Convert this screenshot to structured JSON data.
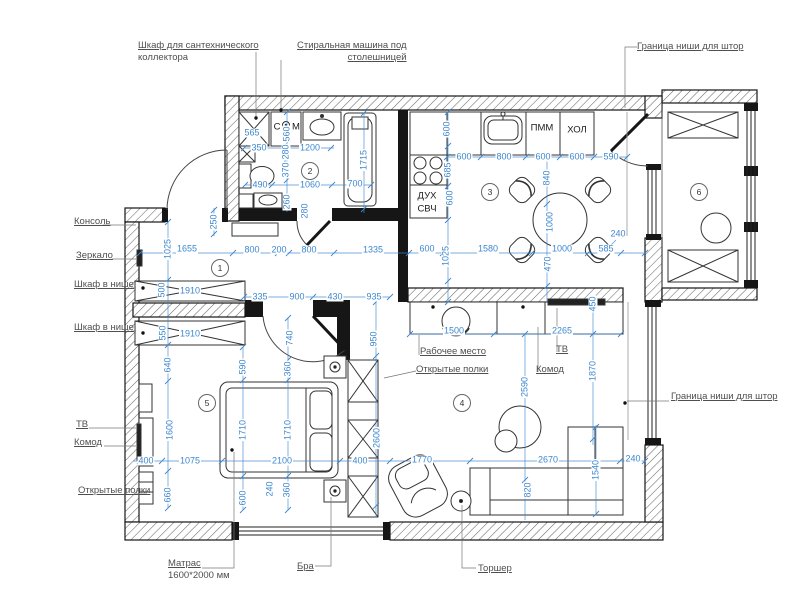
{
  "title": "Apartment furniture floor plan",
  "colors": {
    "dimension": "#3d87cf",
    "callout": "#4f4f4f",
    "wall": "#1c1c1c"
  },
  "rooms": [
    {
      "n": "1",
      "x": 220,
      "y": 268
    },
    {
      "n": "2",
      "x": 310,
      "y": 171
    },
    {
      "n": "3",
      "x": 490,
      "y": 192
    },
    {
      "n": "4",
      "x": 462,
      "y": 403
    },
    {
      "n": "5",
      "x": 207,
      "y": 403
    },
    {
      "n": "6",
      "x": 699,
      "y": 192
    }
  ],
  "plan_labels": [
    {
      "t": "С",
      "x": 277,
      "y": 127
    },
    {
      "t": "М",
      "x": 296,
      "y": 127
    },
    {
      "t": "ДУХ",
      "x": 427,
      "y": 196
    },
    {
      "t": "СВЧ",
      "x": 427,
      "y": 209
    },
    {
      "t": "ПММ",
      "x": 542,
      "y": 128
    },
    {
      "t": "ХОЛ",
      "x": 577,
      "y": 130
    },
    {
      "t": "ТВ",
      "x": 0,
      "y": 0,
      "hidden": true
    }
  ],
  "callouts": [
    {
      "name": "plumbing-cabinet-label",
      "x": 138,
      "y": 40,
      "lines": [
        {
          "t": "Шкаф для сантехнического",
          "u": true
        },
        {
          "t": "коллектора",
          "u": false
        }
      ]
    },
    {
      "name": "washer-label",
      "x": 297,
      "y": 40,
      "align": "right",
      "lines": [
        {
          "t": "Стиральная машина под",
          "u": true
        },
        {
          "t": "столешницей",
          "u": true
        }
      ]
    },
    {
      "name": "curtain-niche-top-label",
      "x": 637,
      "y": 41,
      "lines": [
        {
          "t": "Граница ниши для штор",
          "u": true
        }
      ]
    },
    {
      "name": "curtain-niche-right-label",
      "x": 671,
      "y": 391,
      "lines": [
        {
          "t": "Граница ниши для штор",
          "u": true
        }
      ]
    },
    {
      "name": "console-label",
      "x": 74,
      "y": 216,
      "lines": [
        {
          "t": "Консоль",
          "u": true
        }
      ]
    },
    {
      "name": "mirror-label",
      "x": 76,
      "y": 250,
      "lines": [
        {
          "t": "Зеркало",
          "u": true
        }
      ]
    },
    {
      "name": "niche-wardrobe-label-1",
      "x": 74,
      "y": 279,
      "lines": [
        {
          "t": "Шкаф в нише",
          "u": true
        }
      ]
    },
    {
      "name": "niche-wardrobe-label-2",
      "x": 74,
      "y": 322,
      "lines": [
        {
          "t": "Шкаф в нише",
          "u": true
        }
      ]
    },
    {
      "name": "tv-left-label",
      "x": 76,
      "y": 419,
      "lines": [
        {
          "t": "ТВ",
          "u": true
        }
      ]
    },
    {
      "name": "dresser-left-label",
      "x": 74,
      "y": 437,
      "lines": [
        {
          "t": "Комод",
          "u": true
        }
      ]
    },
    {
      "name": "shelves-left-label",
      "x": 78,
      "y": 485,
      "lines": [
        {
          "t": "Открытые полки",
          "u": true
        }
      ]
    },
    {
      "name": "mattress-label",
      "x": 168,
      "y": 558,
      "lines": [
        {
          "t": "Матрас",
          "u": true
        },
        {
          "t": "1600*2000 мм",
          "u": false
        }
      ]
    },
    {
      "name": "sconce-label",
      "x": 297,
      "y": 561,
      "lines": [
        {
          "t": "Бра",
          "u": true
        }
      ]
    },
    {
      "name": "floorlamp-label",
      "x": 478,
      "y": 563,
      "lines": [
        {
          "t": "Торшер",
          "u": true
        }
      ]
    },
    {
      "name": "workplace-label",
      "x": 420,
      "y": 346,
      "lines": [
        {
          "t": "Рабочее место",
          "u": true
        }
      ]
    },
    {
      "name": "tv-living-label",
      "x": 556,
      "y": 344,
      "lines": [
        {
          "t": "ТВ",
          "u": true
        }
      ]
    },
    {
      "name": "dresser-living-label",
      "x": 536,
      "y": 364,
      "lines": [
        {
          "t": "Комод",
          "u": true
        }
      ]
    },
    {
      "name": "shelves-living-label",
      "x": 416,
      "y": 364,
      "lines": [
        {
          "t": "Открытые полки",
          "u": true
        }
      ]
    }
  ],
  "dimensions": [
    {
      "t": "565",
      "x": 252,
      "y": 133
    },
    {
      "t": "350",
      "x": 259,
      "y": 148
    },
    {
      "t": "560",
      "x": 287,
      "y": 134,
      "v": true
    },
    {
      "t": "280",
      "x": 286,
      "y": 152,
      "v": true
    },
    {
      "t": "1200",
      "x": 310,
      "y": 148
    },
    {
      "t": "370",
      "x": 286,
      "y": 170,
      "v": true
    },
    {
      "t": "490",
      "x": 260,
      "y": 185
    },
    {
      "t": "1060",
      "x": 310,
      "y": 185
    },
    {
      "t": "700",
      "x": 355,
      "y": 184
    },
    {
      "t": "1715",
      "x": 364,
      "y": 160,
      "v": true
    },
    {
      "t": "260",
      "x": 287,
      "y": 202,
      "v": true
    },
    {
      "t": "280",
      "x": 305,
      "y": 211,
      "v": true
    },
    {
      "t": "250",
      "x": 214,
      "y": 222,
      "v": true
    },
    {
      "t": "600",
      "x": 447,
      "y": 129,
      "v": true
    },
    {
      "t": "600",
      "x": 464,
      "y": 157
    },
    {
      "t": "800",
      "x": 504,
      "y": 157
    },
    {
      "t": "600",
      "x": 543,
      "y": 157
    },
    {
      "t": "600",
      "x": 577,
      "y": 157
    },
    {
      "t": "590",
      "x": 611,
      "y": 157
    },
    {
      "t": "685",
      "x": 448,
      "y": 170,
      "v": true
    },
    {
      "t": "840",
      "x": 547,
      "y": 178,
      "v": true
    },
    {
      "t": "600",
      "x": 450,
      "y": 198,
      "v": true
    },
    {
      "t": "1000",
      "x": 550,
      "y": 222,
      "v": true
    },
    {
      "t": "240",
      "x": 618,
      "y": 234
    },
    {
      "t": "585",
      "x": 606,
      "y": 249
    },
    {
      "t": "1000",
      "x": 562,
      "y": 249
    },
    {
      "t": "1580",
      "x": 488,
      "y": 249
    },
    {
      "t": "600",
      "x": 427,
      "y": 249
    },
    {
      "t": "1025",
      "x": 446,
      "y": 256,
      "v": true
    },
    {
      "t": "470",
      "x": 548,
      "y": 264,
      "v": true
    },
    {
      "t": "1025",
      "x": 168,
      "y": 249,
      "v": true
    },
    {
      "t": "1655",
      "x": 187,
      "y": 249
    },
    {
      "t": "800",
      "x": 252,
      "y": 250
    },
    {
      "t": "200",
      "x": 279,
      "y": 250
    },
    {
      "t": "800",
      "x": 309,
      "y": 250
    },
    {
      "t": "1335",
      "x": 373,
      "y": 250
    },
    {
      "t": "500",
      "x": 162,
      "y": 290,
      "v": true
    },
    {
      "t": "1910",
      "x": 190,
      "y": 291
    },
    {
      "t": "335",
      "x": 260,
      "y": 297
    },
    {
      "t": "900",
      "x": 297,
      "y": 297
    },
    {
      "t": "430",
      "x": 335,
      "y": 297
    },
    {
      "t": "935",
      "x": 374,
      "y": 297
    },
    {
      "t": "550",
      "x": 163,
      "y": 333,
      "v": true
    },
    {
      "t": "1910",
      "x": 190,
      "y": 334
    },
    {
      "t": "740",
      "x": 290,
      "y": 338,
      "v": true
    },
    {
      "t": "950",
      "x": 374,
      "y": 339,
      "v": true
    },
    {
      "t": "640",
      "x": 168,
      "y": 365,
      "v": true
    },
    {
      "t": "590",
      "x": 243,
      "y": 367,
      "v": true
    },
    {
      "t": "360",
      "x": 288,
      "y": 369,
      "v": true
    },
    {
      "t": "1600",
      "x": 170,
      "y": 430,
      "v": true
    },
    {
      "t": "1710",
      "x": 243,
      "y": 430,
      "v": true
    },
    {
      "t": "1710",
      "x": 288,
      "y": 430,
      "v": true
    },
    {
      "t": "400",
      "x": 146,
      "y": 461
    },
    {
      "t": "1075",
      "x": 190,
      "y": 461
    },
    {
      "t": "2100",
      "x": 282,
      "y": 461
    },
    {
      "t": "400",
      "x": 360,
      "y": 461
    },
    {
      "t": "660",
      "x": 168,
      "y": 495,
      "v": true
    },
    {
      "t": "600",
      "x": 243,
      "y": 498,
      "v": true
    },
    {
      "t": "240",
      "x": 270,
      "y": 489,
      "v": true
    },
    {
      "t": "360",
      "x": 287,
      "y": 490,
      "v": true
    },
    {
      "t": "2600",
      "x": 377,
      "y": 438,
      "v": true
    },
    {
      "t": "1500",
      "x": 454,
      "y": 331
    },
    {
      "t": "2265",
      "x": 562,
      "y": 331
    },
    {
      "t": "450",
      "x": 593,
      "y": 304,
      "v": true
    },
    {
      "t": "2590",
      "x": 525,
      "y": 387,
      "v": true
    },
    {
      "t": "1870",
      "x": 593,
      "y": 371,
      "v": true
    },
    {
      "t": "1770",
      "x": 422,
      "y": 460
    },
    {
      "t": "2670",
      "x": 548,
      "y": 460
    },
    {
      "t": "1540",
      "x": 596,
      "y": 470,
      "v": true
    },
    {
      "t": "240",
      "x": 633,
      "y": 459
    },
    {
      "t": "820",
      "x": 528,
      "y": 490,
      "v": true
    }
  ]
}
